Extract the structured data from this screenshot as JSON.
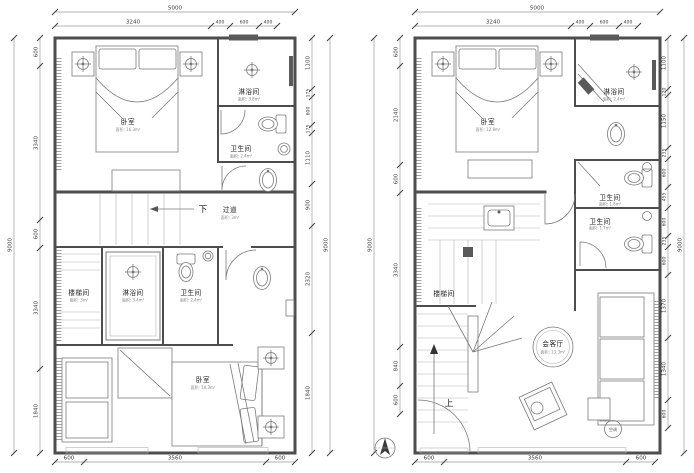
{
  "left": {
    "dims": {
      "top_total": "5000",
      "top_segs": [
        "3240",
        "400",
        "600",
        "400"
      ],
      "left_total": "9000",
      "left_segs": [
        "600",
        "3340",
        "600",
        "3340",
        "1840"
      ],
      "right_total": "9000",
      "right_segs": [
        "1100",
        "175",
        "600",
        "175",
        "1110",
        "900",
        "2320",
        "1840"
      ],
      "bottom_segs": [
        "600",
        "3560",
        "600"
      ]
    },
    "rooms": {
      "bedroom_top": {
        "name": "卧室",
        "area": "面积: 16.3m²"
      },
      "shower_top": {
        "name": "淋浴间",
        "area": "面积: 3.8m²"
      },
      "wc_top": {
        "name": "卫生间",
        "area": "面积: 2.4m²"
      },
      "corridor": {
        "name": "过道",
        "area": "面积: 3m²"
      },
      "stairwell": {
        "name": "楼梯间",
        "area": "面积: 3m²"
      },
      "shower_low": {
        "name": "淋浴间",
        "area": "面积: 3.4m²"
      },
      "wc_low": {
        "name": "卫生间",
        "area": "面积: 2.4m²"
      },
      "bedroom_bottom": {
        "name": "卧室",
        "area": "面积: 14.3m²"
      }
    },
    "annotations": {
      "down": "下"
    }
  },
  "right": {
    "dims": {
      "top_total": "5000",
      "top_segs": [
        "3240",
        "400",
        "600",
        "400"
      ],
      "left_total": "9000",
      "left_segs": [
        "600",
        "2140",
        "600",
        "3340",
        "840",
        "600"
      ],
      "right_total": "9000",
      "right_segs": [
        "1100",
        "120",
        "1150",
        "235",
        "600",
        "455",
        "600",
        "235",
        "600",
        "1370",
        "1340",
        "600"
      ],
      "bottom_segs": [
        "600",
        "3560",
        "600"
      ]
    },
    "rooms": {
      "bedroom": {
        "name": "卧室",
        "area": "面积: 12.8m²"
      },
      "shower": {
        "name": "淋浴间",
        "area": "面积: 2.4m²"
      },
      "wc1": {
        "name": "卫生间",
        "area": "面积: 1.8m²"
      },
      "wc2": {
        "name": "卫生间",
        "area": "面积: 1.7m²"
      },
      "stairwell": {
        "name": "楼梯间"
      },
      "living": {
        "name": "会客厅",
        "area": "面积: 13.3m²"
      }
    },
    "annotations": {
      "up": "上",
      "ac": "空调"
    }
  },
  "colors": {
    "wall": "#4d4d4d",
    "dim_line": "#9a9a9a",
    "text": "#3d3d3d",
    "dark_fixture": "#5a5a5a"
  }
}
